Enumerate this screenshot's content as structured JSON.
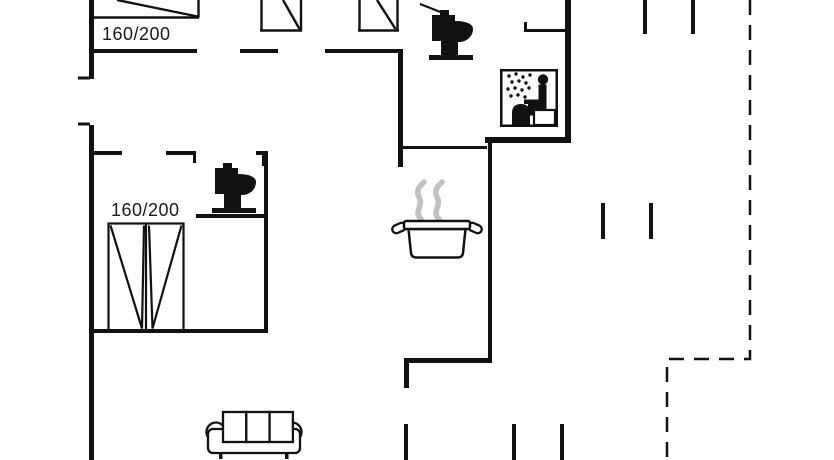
{
  "colors": {
    "background": "#ffffff",
    "lines": "#111111",
    "steam": "#c2c2c2"
  },
  "labels": {
    "bed_top_left": "160/200",
    "bed_top_middle": "160/200",
    "bed_middle_left": "160/200"
  },
  "icons": {
    "bathroom_top": "toilet-icon",
    "bedroom_ensuite": "toilet-icon",
    "shower_room": "shower-icon",
    "kitchen": "cooking-pot-icon",
    "living_room": "sofa-icon",
    "beds": [
      "single-bed-icon",
      "single-bed-icon",
      "single-bed-icon",
      "double-bed-icon"
    ],
    "outdoor": "terrace-dashed-boundary"
  }
}
